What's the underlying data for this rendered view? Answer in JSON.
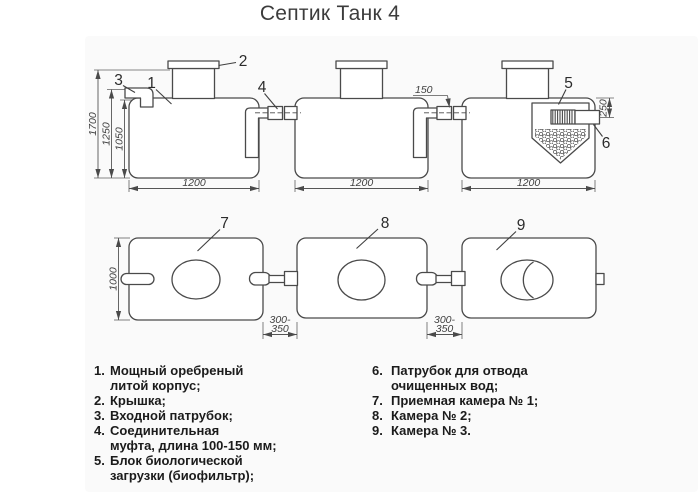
{
  "title": "Септик Танк 4",
  "side_view": {
    "callouts": {
      "c1": "1",
      "c2": "2",
      "c3": "3",
      "c4": "4",
      "c5": "5",
      "c6": "6"
    },
    "dims": {
      "total_height": "1700",
      "inlet_height": "1250",
      "inner_height": "1050",
      "tank_width": "1200",
      "coupling_length": "150",
      "outlet_height": "250"
    }
  },
  "top_view": {
    "callouts": {
      "c7": "7",
      "c8": "8",
      "c9": "9"
    },
    "dims": {
      "body_width": "1000",
      "gap_line1": "300-",
      "gap_line2": "350"
    }
  },
  "legend": {
    "left": [
      {
        "num": "1.",
        "lines": [
          "Мощный оребреный",
          "литой корпус;"
        ]
      },
      {
        "num": "2.",
        "lines": [
          "Крышка;"
        ]
      },
      {
        "num": "3.",
        "lines": [
          "Входной патрубок;"
        ]
      },
      {
        "num": "4.",
        "lines": [
          "Соединительная",
          "муфта, длина 100-150 мм;"
        ]
      },
      {
        "num": "5.",
        "lines": [
          "Блок биологической",
          "загрузки (биофильтр);"
        ]
      }
    ],
    "right": [
      {
        "num": "6.",
        "lines": [
          "Патрубок для отвода",
          "очищенных вод;"
        ]
      },
      {
        "num": "7.",
        "lines": [
          "Приемная камера № 1;"
        ]
      },
      {
        "num": "8.",
        "lines": [
          "Камера № 2;"
        ]
      },
      {
        "num": "9.",
        "lines": [
          "Камера № 3."
        ]
      }
    ]
  },
  "colors": {
    "ink": "#4a4a4a",
    "dim_line": "#5f5f5f",
    "text": "#2b2b2b",
    "background": "#ffffff"
  }
}
